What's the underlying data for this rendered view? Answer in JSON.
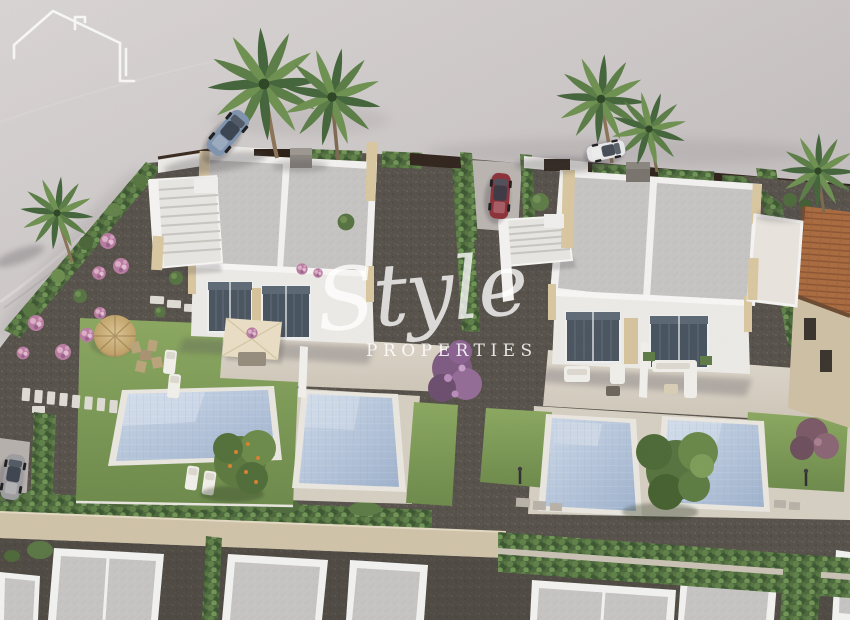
{
  "meta": {
    "title": "Aerial 3D architectural render of new-build villas with private pools",
    "image_type": "3d-architectural-render",
    "width_px": 850,
    "height_px": 620
  },
  "watermark": {
    "brand_script": "Style",
    "brand_caps": "PROPERTIES",
    "logo_icon": "house-outline-icon",
    "color": "#ffffff",
    "opacity": 0.8
  },
  "palette": {
    "ground_gray": "#c7c1c2",
    "road_light": "#d4d0cf",
    "gravel_dark": "#55504a",
    "lawn_green": "#7e9b55",
    "hedge_green": "#4c673c",
    "pool_water": "#b4c4da",
    "pool_coping": "#e9e6df",
    "villa_white": "#f2f1ee",
    "roof_gray": "#c6c4c2",
    "stone_beige": "#d8c69f",
    "terrace_beige": "#d9d2c6",
    "boundary_wall_dark": "#30241c",
    "perimeter_wall_beige": "#cfc2a8",
    "tile_roof_terracotta": "#a96a3e",
    "flower_pink": "#c08ba8",
    "bougainvillea_purple": "#8a6190",
    "car_blue": "#7e93ad",
    "car_red": "#8c3038",
    "car_white": "#e8e8ea",
    "car_gray": "#9d9c9e",
    "straw_umbrella": "#c9ae78",
    "canopy_cream": "#e9dec4"
  },
  "scene": {
    "villas": 2,
    "swimming_pools": 4,
    "palm_trees": 6,
    "cars": 4,
    "objects": [
      "left-villa-duplex",
      "right-villa-duplex",
      "roof-terrace-stairs-left",
      "roof-terrace-stairs-right",
      "pool-1",
      "pool-2",
      "pool-3",
      "pool-4",
      "blue-convertible-car",
      "red-parked-car",
      "white-parked-car",
      "gray-parked-car",
      "straw-parasol",
      "cream-canopy",
      "outdoor-sofa-set",
      "sun-loungers",
      "dining-set",
      "orange-fruit-tree",
      "large-garden-tree",
      "bougainvillea-trees",
      "pink-flower-shrubs",
      "cypress-hedges",
      "perimeter-hedge-rows",
      "stepping-stone-path",
      "street-lamps",
      "neighbor-tile-roof-house",
      "bottom-row-houses",
      "watermark-logo"
    ]
  }
}
